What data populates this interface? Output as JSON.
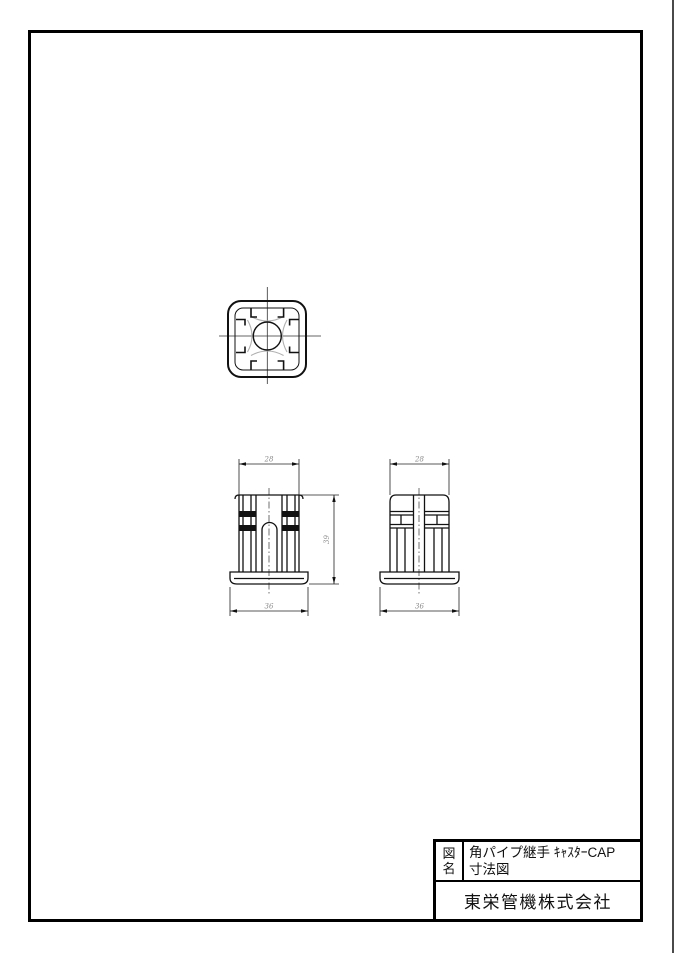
{
  "title_block": {
    "label_char1": "図",
    "label_char2": "名",
    "title_line1": "角パイプ継手 ｷｬｽﾀｰCAP",
    "title_line2": "寸法図",
    "company": "東栄管機株式会社"
  },
  "dims": {
    "front": {
      "top_width": "28",
      "bottom_width": "36",
      "height": "39"
    },
    "side": {
      "top_width": "28",
      "bottom_width": "36"
    }
  },
  "colors": {
    "line": "#111111",
    "dim_line": "#222222",
    "dim_text": "#8a8a8a",
    "frame": "#000000",
    "hidden_detail": "#b0b0b0"
  }
}
